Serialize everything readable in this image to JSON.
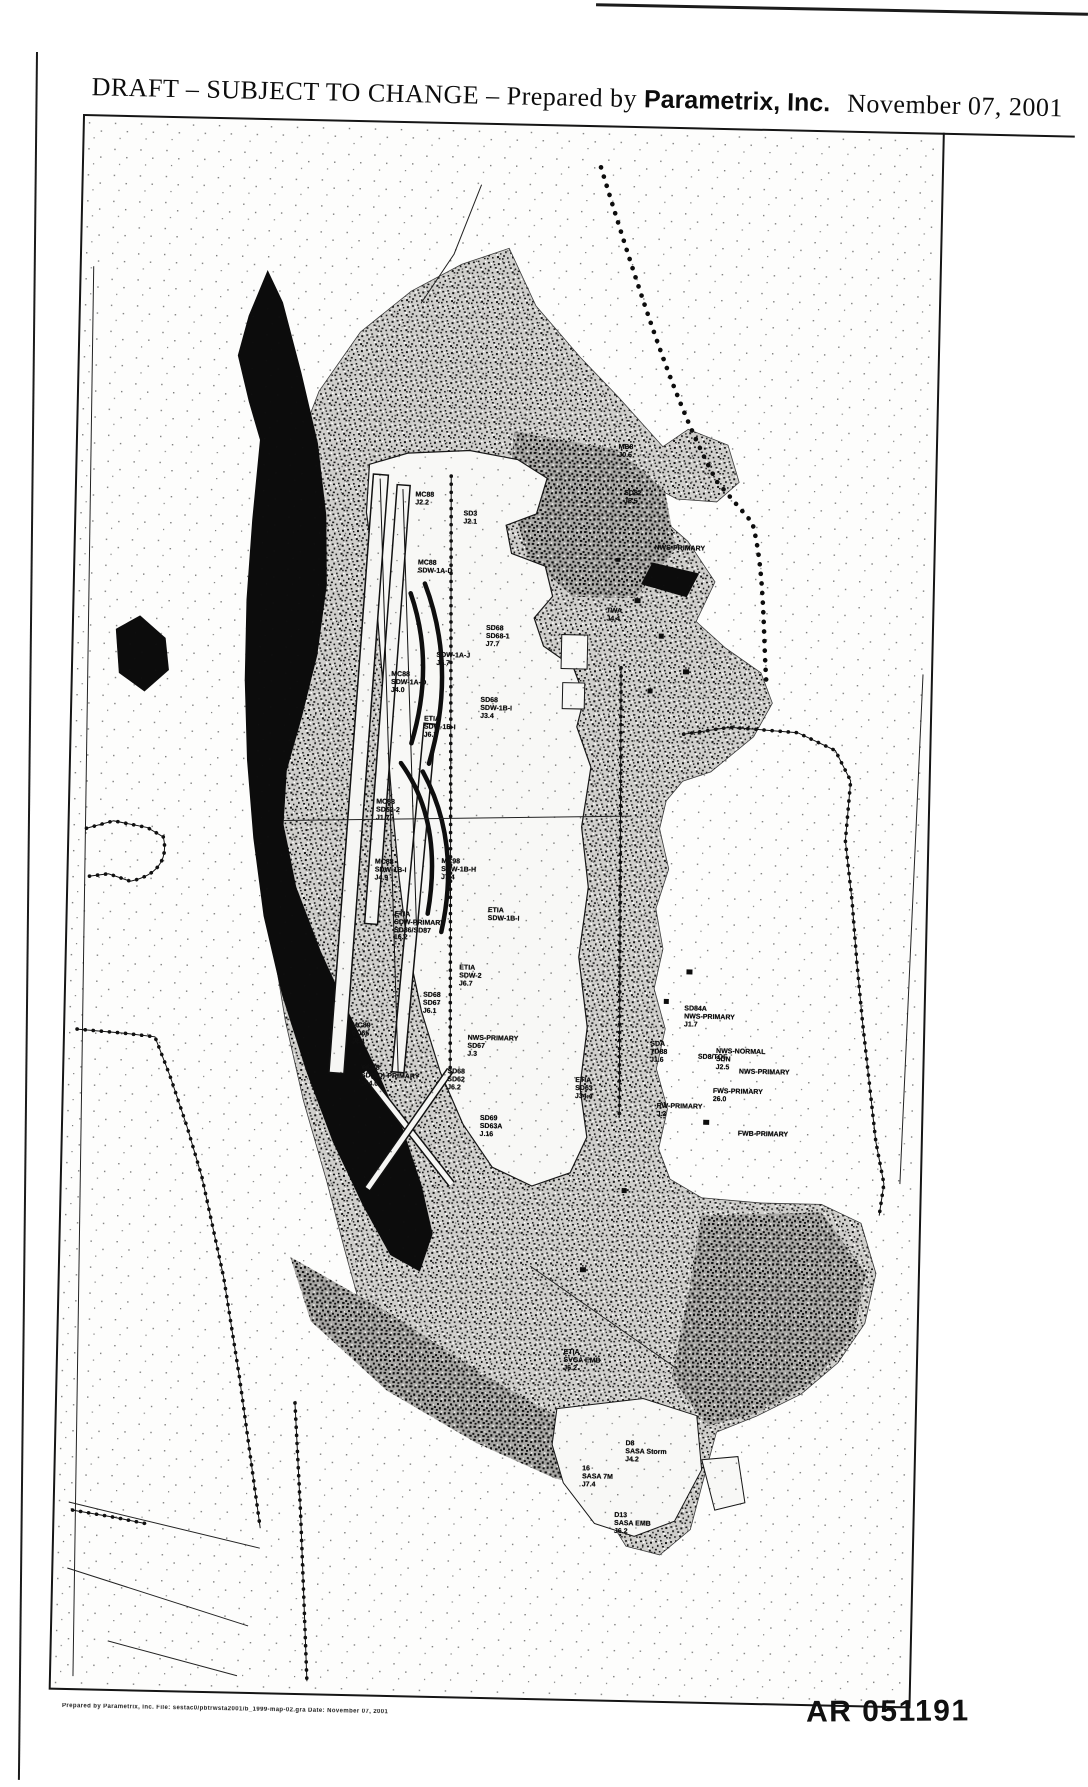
{
  "page": {
    "header": {
      "draft_text": "DRAFT – SUBJECT TO CHANGE – Prepared by",
      "company": "Parametrix, Inc.",
      "date": "November 07, 2001"
    },
    "stamp": "AR 051191",
    "footer_microprint": "Prepared by Parametrix, Inc.   File: sestac0/pbtrwsta2001/b_1999-map-02.gra   Date: November 07, 2001"
  },
  "map": {
    "description": "Monochrome scanned watershed / drainage sub-basin map of airport vicinity",
    "labels": [
      {
        "text": "MC88\nSDW-1A-D",
        "x": 360,
        "y": 436
      },
      {
        "text": "MC88\nJ2.2",
        "x": 348,
        "y": 368
      },
      {
        "text": "SD3\nJ2.1",
        "x": 394,
        "y": 386
      },
      {
        "text": "SD68\nSD68-1\nJ7.7",
        "x": 424,
        "y": 500
      },
      {
        "text": "SDW-1A-J\nJ5.7",
        "x": 380,
        "y": 528
      },
      {
        "text": "MC88\nSDW-1A-O\nJ4.0",
        "x": 336,
        "y": 548
      },
      {
        "text": "SD68\nSDW-1B-I\nJ3.4",
        "x": 424,
        "y": 572
      },
      {
        "text": "ETIA\nSDW-1B-I\nJ6.7",
        "x": 368,
        "y": 592
      },
      {
        "text": "MC88\nSD62-2\nJ1.7",
        "x": 318,
        "y": 676
      },
      {
        "text": "MC88\nSDW-1B-I\nJ4.9",
        "x": 322,
        "y": 736
      },
      {
        "text": "MC98\nSDW-1B-H\nJ7.4",
        "x": 390,
        "y": 734
      },
      {
        "text": "ETIA\nSDW-1B-I",
        "x": 436,
        "y": 782
      },
      {
        "text": "ETIA\nSDW-2\nJ6.7",
        "x": 404,
        "y": 840
      },
      {
        "text": "ETIA\nSDW-PRIMARY\nSD86/SD87\n16.2",
        "x": 352,
        "y": 788
      },
      {
        "text": "MC89\nSD65\nJ6.1",
        "x": 296,
        "y": 900
      },
      {
        "text": "SD68\nSD67\nJ6.1",
        "x": 366,
        "y": 868
      },
      {
        "text": "NWS-PRIMARY\nSD67\nJ.3",
        "x": 428,
        "y": 910
      },
      {
        "text": "MC88\nSD(SD)-PRIMARY\nJ44.0",
        "x": 326,
        "y": 942
      },
      {
        "text": "SD68\nSD62\nJ6.2",
        "x": 392,
        "y": 944
      },
      {
        "text": "SD69\nSD63A\nJ.16",
        "x": 428,
        "y": 990
      },
      {
        "text": "ETIA\nSD63\nJ34.4",
        "x": 520,
        "y": 950
      },
      {
        "text": "SD84A\nNWS-PRIMARY\nJ1.7",
        "x": 644,
        "y": 876
      },
      {
        "text": "SDA\nTD88\nJ1.6",
        "x": 594,
        "y": 912
      },
      {
        "text": "NWS-NORMAL\nSDN\nJ2.5",
        "x": 676,
        "y": 918
      },
      {
        "text": "NWS-PRIMARY",
        "x": 700,
        "y": 938
      },
      {
        "text": "SD8/TOF",
        "x": 648,
        "y": 924
      },
      {
        "text": "FWS-PRIMARY\n26.0",
        "x": 674,
        "y": 958
      },
      {
        "text": "RW-PRIMARY\nJ.2",
        "x": 616,
        "y": 974
      },
      {
        "text": "FWB-PRIMARY",
        "x": 700,
        "y": 1000
      },
      {
        "text": "MB8\nJ0.5",
        "x": 548,
        "y": 316
      },
      {
        "text": "SD82\nJ5.5",
        "x": 556,
        "y": 362
      },
      {
        "text": "NWS-PRIMARY",
        "x": 604,
        "y": 416
      },
      {
        "text": "TWA\nJ4.4",
        "x": 540,
        "y": 480
      },
      {
        "text": "ETIA\nSVGA EMB\nJ6.2",
        "x": 524,
        "y": 1222
      },
      {
        "text": "D8\nSASA Storm\nJ4.2",
        "x": 590,
        "y": 1312
      },
      {
        "text": "16\nSASA 7M\nJ7.4",
        "x": 542,
        "y": 1338
      },
      {
        "text": "D13\nSASA EMB\nJ6.2",
        "x": 578,
        "y": 1384
      }
    ]
  }
}
